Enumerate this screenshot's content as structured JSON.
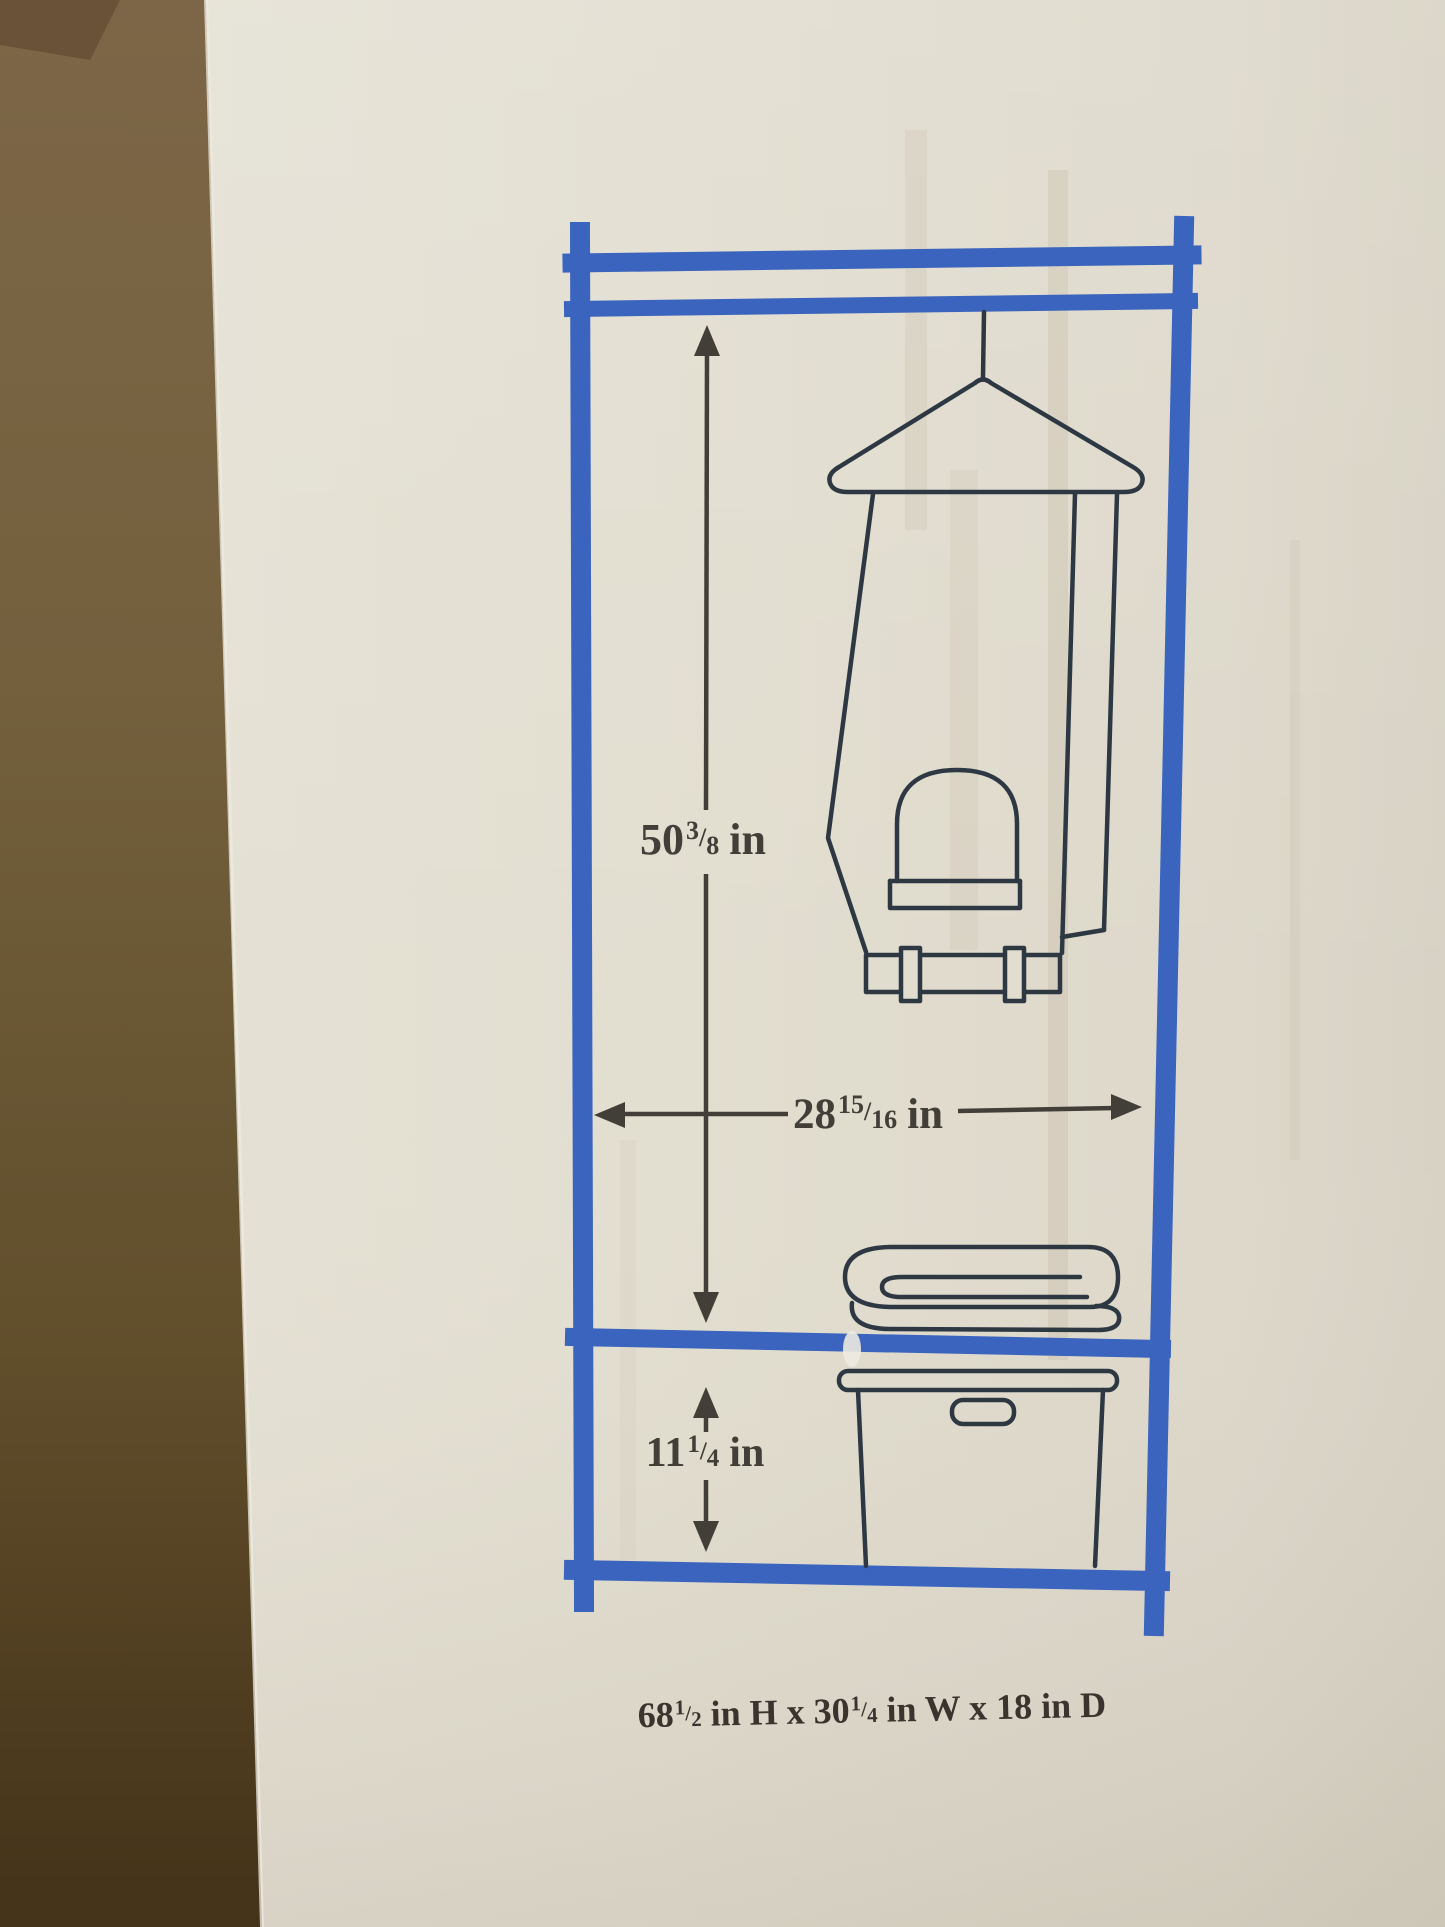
{
  "photo_subject": "product box with printed garment rack dimension diagram",
  "colors": {
    "frame_blue": "#3c66c2",
    "drawing_line": "#2e3a45",
    "ink_dark": "#44403a",
    "box_face": "#e7e3d5",
    "cardboard_top": "#7f6949",
    "cardboard_bottom": "#46341a"
  },
  "dims": {
    "height": {
      "whole": "50",
      "num": "3",
      "sep": "/",
      "den": "8",
      "unit": "in"
    },
    "width": {
      "whole": "28",
      "num": "15",
      "sep": "/",
      "den": "16",
      "unit": "in"
    },
    "shelf": {
      "whole": "11",
      "num": "1",
      "sep": "/",
      "den": "4",
      "unit": "in"
    }
  },
  "caption": {
    "p1": "68",
    "f1n": "1",
    "sep1": "/",
    "f1d": "2",
    "m1": "in H x",
    "p2": "30",
    "f2n": "1",
    "sep2": "/",
    "f2d": "4",
    "m2": "in W x",
    "p3": "18",
    "m3": "in D"
  }
}
